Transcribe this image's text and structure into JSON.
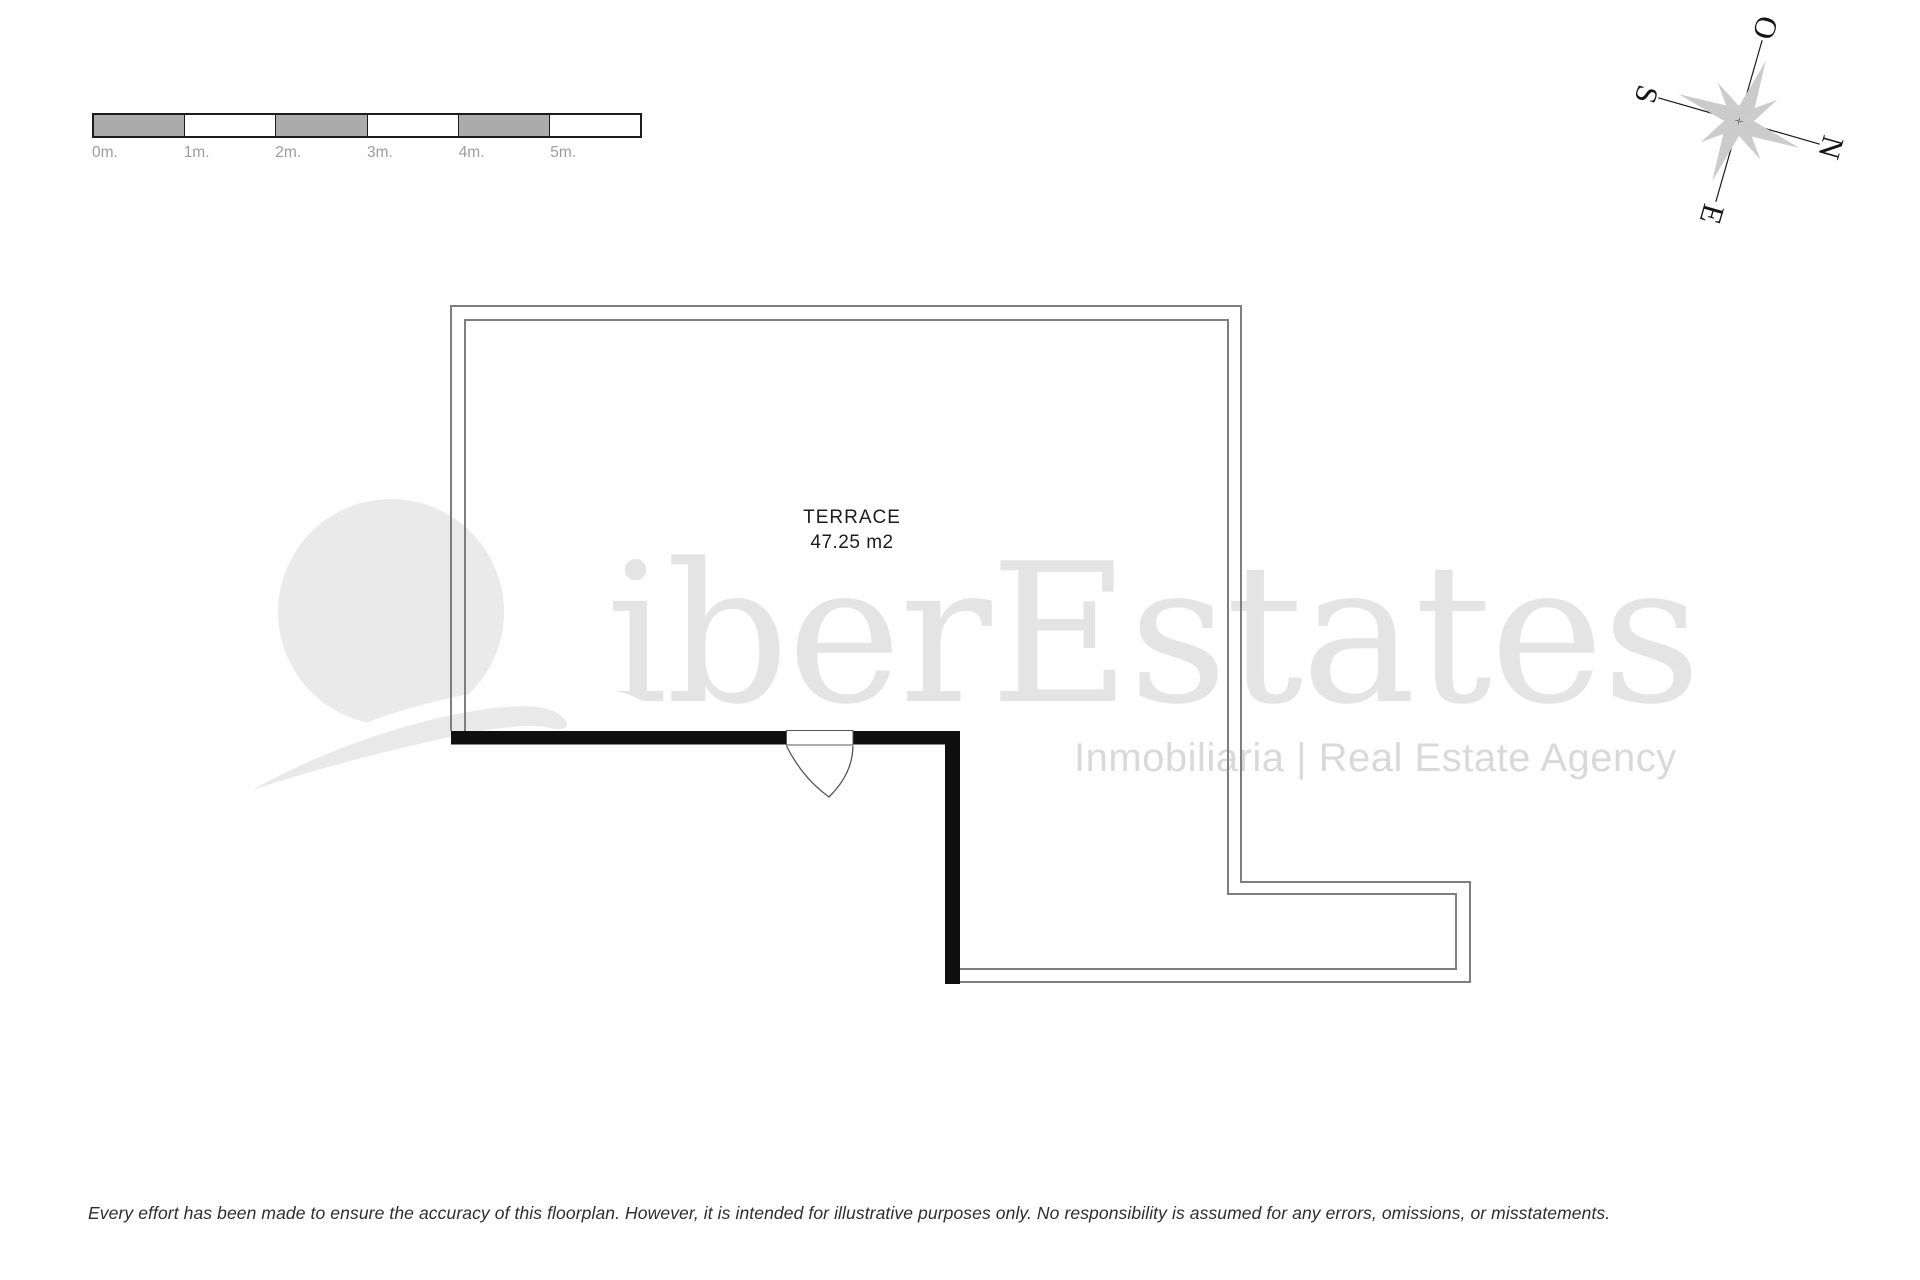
{
  "scale_bar": {
    "labels": [
      "0m.",
      "1m.",
      "2m.",
      "3m.",
      "4m.",
      "5m."
    ],
    "segment_gray": "#ababab",
    "segment_white": "#ffffff",
    "border_color": "#1c1c1c",
    "label_color": "#9d9d9d"
  },
  "compass": {
    "letters": {
      "west": "O",
      "south": "S",
      "north": "N",
      "east": "E"
    },
    "blade_color": "#cccccc",
    "line_color": "#1a1a1a"
  },
  "floorplan": {
    "room": {
      "name": "TERRACE",
      "area": "47.25 m2"
    },
    "wall_thick_color": "#0f0f0f",
    "wall_thin_color": "#7e7e7e"
  },
  "watermark": {
    "brand": "iberEstates",
    "tagline": "Inmobiliaria | Real Estate Agency",
    "brand_color": "#e4e4e4",
    "tagline_color": "#d9d9d9",
    "logo_color": "#eaeaea"
  },
  "disclaimer": {
    "text": "Every effort has been made to ensure the accuracy of this floorplan. However, it is intended for illustrative purposes only. No responsibility is assumed for any errors, omissions, or misstatements."
  }
}
